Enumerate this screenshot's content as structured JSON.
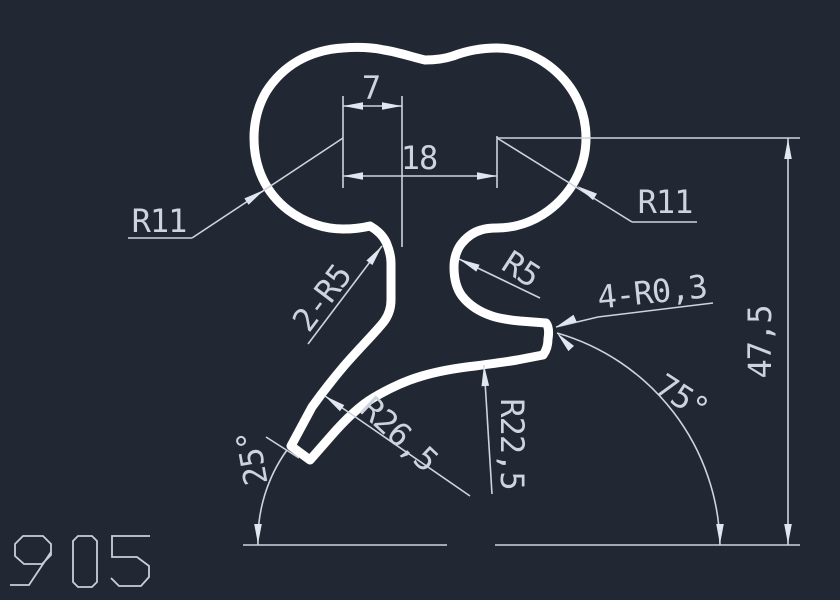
{
  "drawing_type": "CAD profile cross-section with dimensions",
  "part_number": "905",
  "colors": {
    "background": "#212834",
    "linework": "#ced4de",
    "profile_outline": "#ffffff"
  },
  "dimensions": {
    "neck_width": "7",
    "lobe_center_distance": "18",
    "lobe_radius_left": "R11",
    "lobe_radius_right": "R11",
    "neck_fillets": "2-R5",
    "cove_radius": "R5",
    "end_corner_radii": "4-R0,3",
    "overall_height": "47,5",
    "band_outer_radius": "R26,5",
    "band_inner_radius": "R22,5",
    "right_end_angle": "75°",
    "left_end_angle": "25°"
  }
}
